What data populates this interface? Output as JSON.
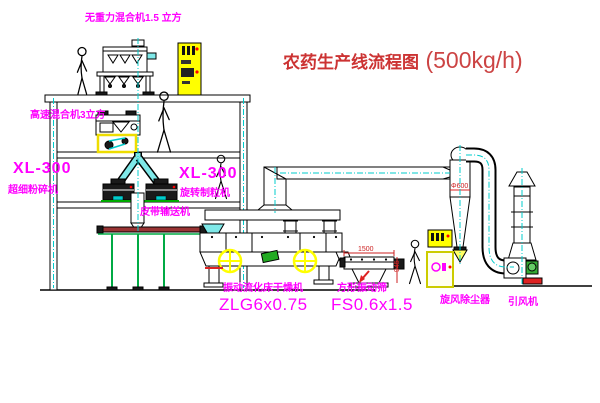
{
  "title": {
    "name": "农药生产线流程图",
    "capacity": "(500kg/h)"
  },
  "equipment_labels": {
    "gravity_mixer": "无重力混合机1.5 立方",
    "high_speed_mixer": "高速混合机3立方",
    "pulverizer_model": "XL-300",
    "pulverizer_name": "超细粉碎机",
    "granulator_model": "XL-300",
    "granulator_name": "旋转制粒机",
    "belt_conveyor": "皮带输送机",
    "dryer_name": "振动流化床干燥机",
    "dryer_model": "ZLG6x0.75",
    "screen_name": "方形振动筛",
    "screen_model": "FS0.6x1.5",
    "cyclone_dust_collector": "旋风除尘器",
    "induced_draft_fan": "引风机"
  },
  "dimensions": {
    "cyclone_diameter": "Φ600",
    "screen_length": "1500",
    "screen_height": "945"
  },
  "colors": {
    "label_magenta": "#FF00FF",
    "title_red": "#CC3333",
    "line_black": "#000000",
    "flow_cyan": "#00CCCC",
    "cabinet_yellow": "#FFFF00",
    "motor_green": "#33AA33",
    "base_red": "#DD2222"
  }
}
